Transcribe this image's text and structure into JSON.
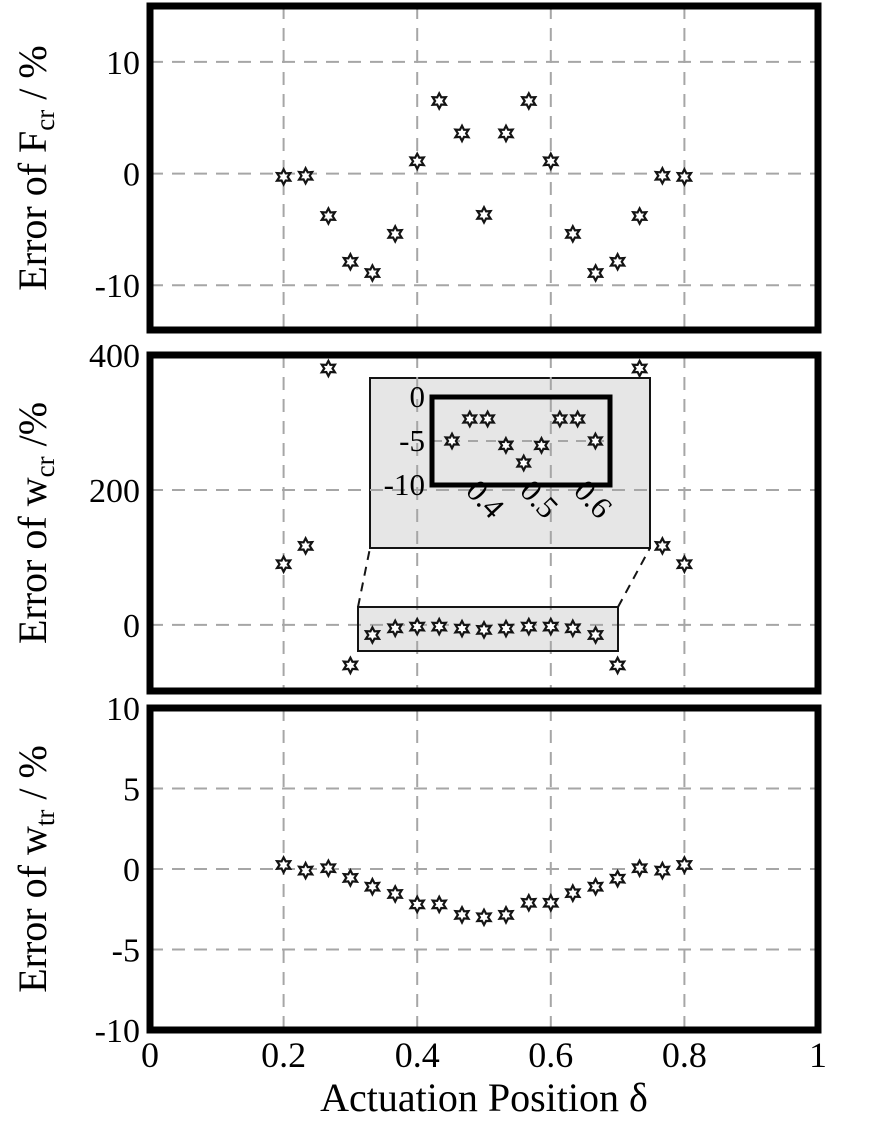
{
  "figure": {
    "x_axis_label": "Actuation Position δ",
    "marker": "open-six-pointed-star-icon",
    "colors": {
      "axes": "#000000",
      "grid": "#a6a6a6",
      "inset_fill": "#e6e6e6",
      "marker_fill": "#ffffff",
      "marker_stroke": "#141414"
    }
  },
  "chart_data": [
    {
      "type": "scatter",
      "id": "error-fcr",
      "ylabel": {
        "pre": "Error of F",
        "sub": "cr",
        "post": " / %"
      },
      "xlim": [
        0,
        1
      ],
      "ylim": [
        -14,
        15
      ],
      "yticks": [
        10,
        0,
        -10
      ],
      "xgrid": [
        0.2,
        0.4,
        0.6,
        0.8
      ],
      "x": [
        0.2,
        0.233,
        0.267,
        0.3,
        0.333,
        0.367,
        0.4,
        0.433,
        0.467,
        0.5,
        0.533,
        0.567,
        0.6,
        0.633,
        0.667,
        0.7,
        0.733,
        0.767,
        0.8
      ],
      "y": [
        -0.3,
        -0.2,
        -3.8,
        -7.9,
        -8.9,
        -5.4,
        1.1,
        6.5,
        3.6,
        -3.7,
        3.6,
        6.5,
        1.1,
        -5.4,
        -8.9,
        -7.9,
        -3.8,
        -0.2,
        -0.3
      ]
    },
    {
      "type": "scatter",
      "id": "error-wcr",
      "ylabel": {
        "pre": "Error of w",
        "sub": "cr",
        "post": " /%"
      },
      "xlim": [
        0,
        1
      ],
      "ylim": [
        -98,
        400
      ],
      "yticks": [
        400,
        200,
        0
      ],
      "xgrid": [
        0.2,
        0.4,
        0.6,
        0.8
      ],
      "x": [
        0.2,
        0.233,
        0.267,
        0.3,
        0.333,
        0.367,
        0.4,
        0.433,
        0.467,
        0.5,
        0.533,
        0.567,
        0.6,
        0.633,
        0.667,
        0.7,
        0.733,
        0.767,
        0.8
      ],
      "y": [
        90,
        117,
        380,
        -60,
        -15,
        -5,
        -2.5,
        -2.5,
        -5.5,
        -7.5,
        -5.5,
        -2.5,
        -2.5,
        -5,
        -15,
        -60,
        380,
        117,
        90
      ],
      "inset": {
        "type": "scatter",
        "xlim": [
          0.33,
          0.66
        ],
        "ylim": [
          -10,
          0
        ],
        "yticks": [
          0,
          -5,
          -10
        ],
        "xticks": [
          0.4,
          0.5,
          0.6
        ],
        "x": [
          0.367,
          0.4,
          0.433,
          0.467,
          0.5,
          0.533,
          0.567,
          0.6,
          0.633
        ],
        "y": [
          -5,
          -2.5,
          -2.5,
          -5.5,
          -7.5,
          -5.5,
          -2.5,
          -2.5,
          -5
        ]
      }
    },
    {
      "type": "scatter",
      "id": "error-wtr",
      "ylabel": {
        "pre": "Error of w",
        "sub": "tr",
        "post": " / %"
      },
      "xlabel": "Actuation Position δ",
      "xlim": [
        0,
        1
      ],
      "ylim": [
        -10,
        10
      ],
      "yticks": [
        10,
        5,
        0,
        -5,
        -10
      ],
      "xticks": [
        0,
        0.2,
        0.4,
        0.6,
        0.8,
        1
      ],
      "xgrid": [
        0.2,
        0.4,
        0.6,
        0.8
      ],
      "x": [
        0.2,
        0.233,
        0.267,
        0.3,
        0.333,
        0.367,
        0.4,
        0.433,
        0.467,
        0.5,
        0.533,
        0.567,
        0.6,
        0.633,
        0.667,
        0.7,
        0.733,
        0.767,
        0.8
      ],
      "y": [
        0.25,
        -0.1,
        0.05,
        -0.55,
        -1.1,
        -1.55,
        -2.2,
        -2.2,
        -2.85,
        -3.0,
        -2.85,
        -2.1,
        -2.1,
        -1.5,
        -1.1,
        -0.6,
        0.05,
        -0.1,
        0.25
      ]
    }
  ]
}
